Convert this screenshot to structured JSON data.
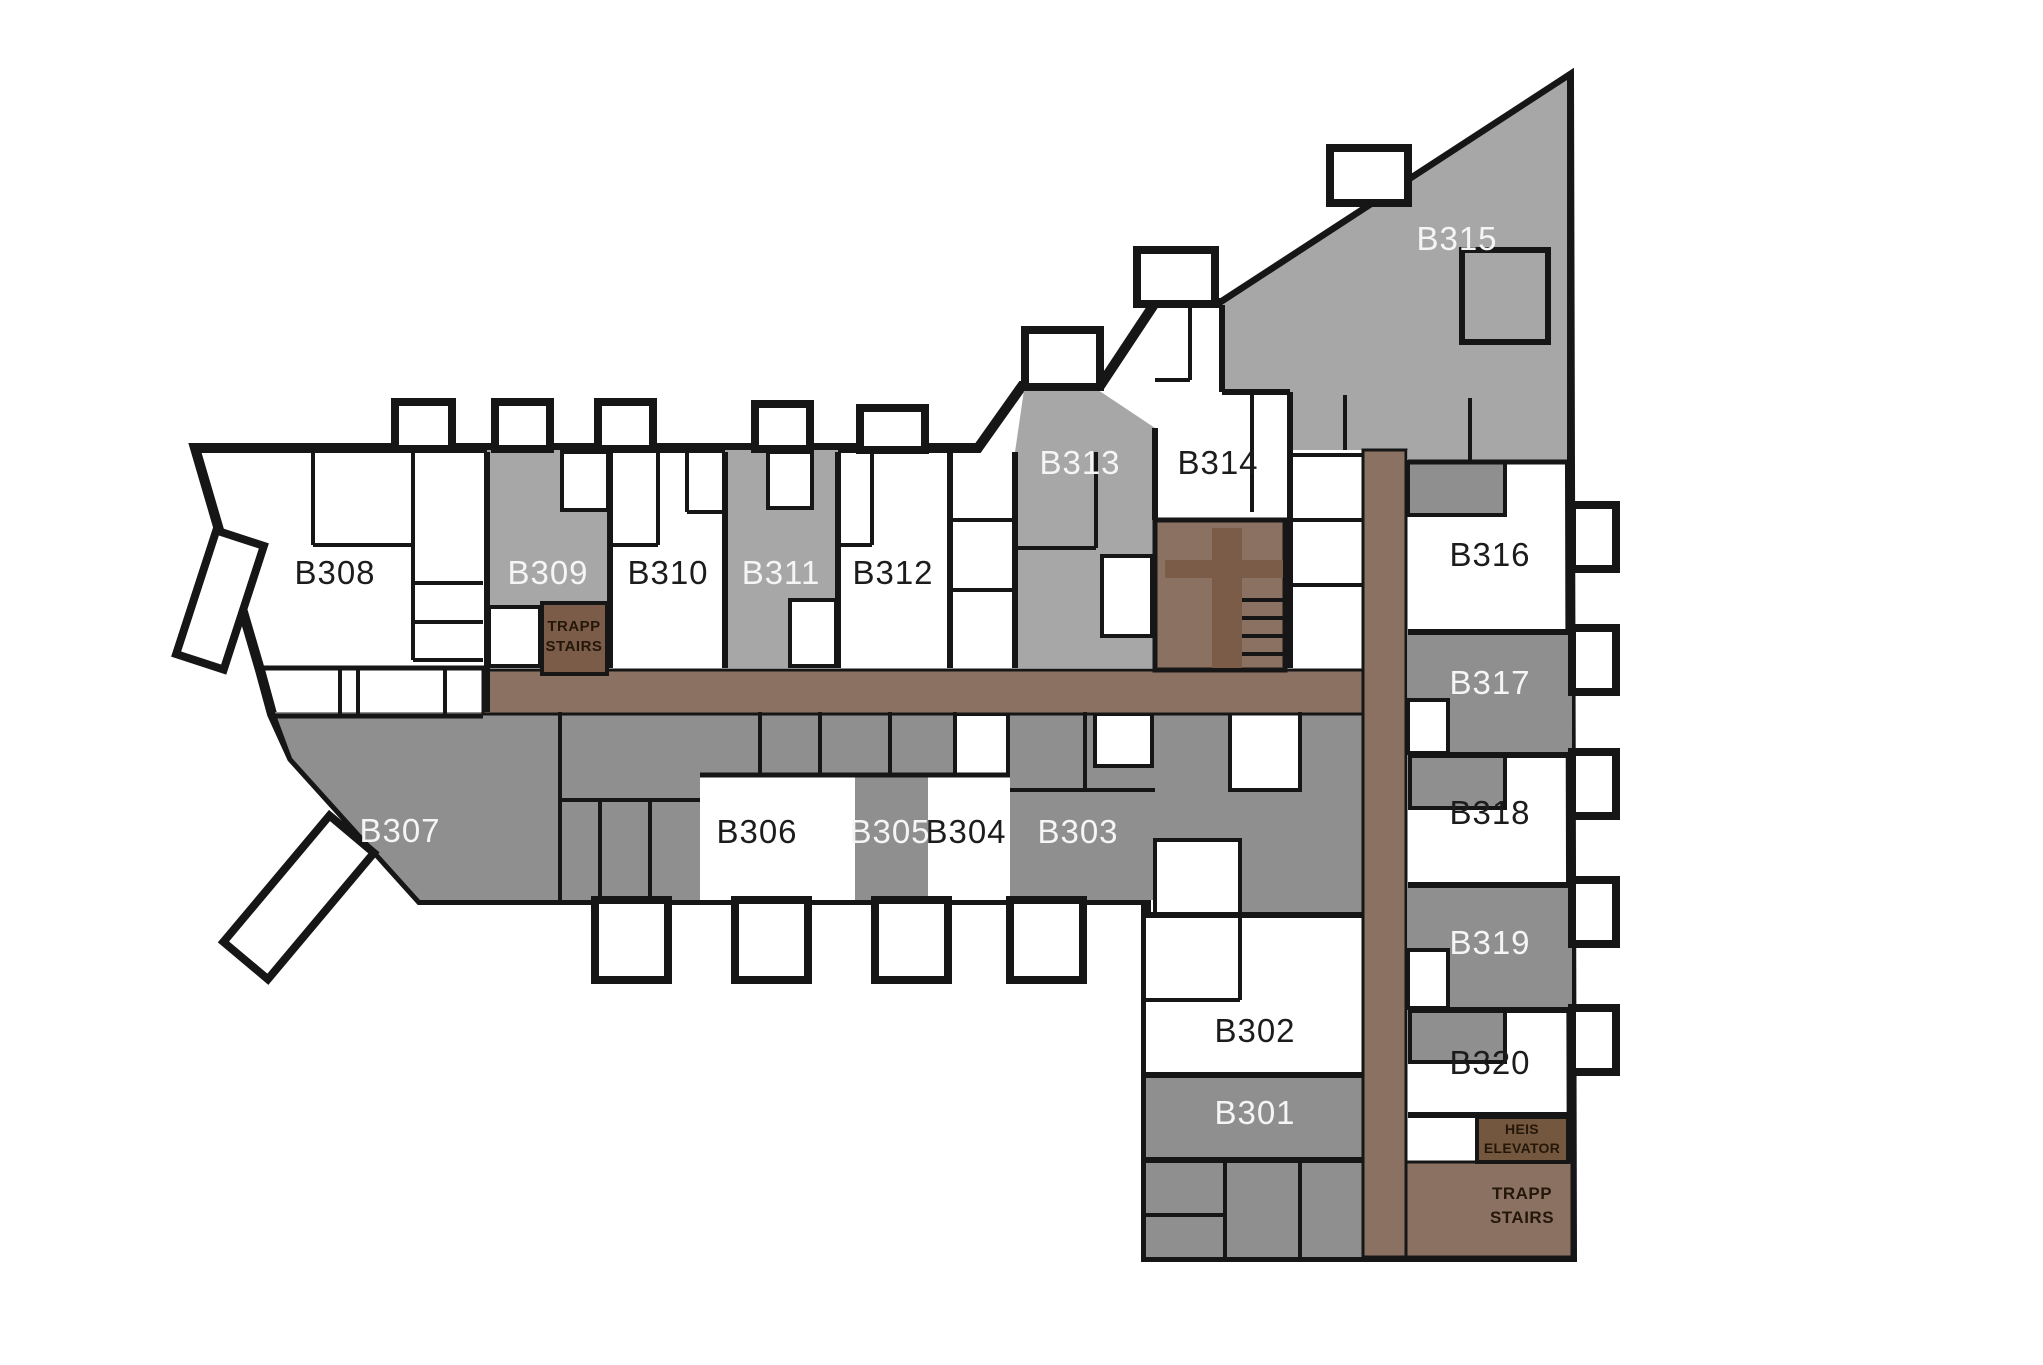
{
  "plan_type": "apartment-floor-plan",
  "rooms": [
    {
      "id": "B301",
      "label": "B301",
      "shade": "gray"
    },
    {
      "id": "B302",
      "label": "B302",
      "shade": "white"
    },
    {
      "id": "B303",
      "label": "B303",
      "shade": "gray"
    },
    {
      "id": "B304",
      "label": "B304",
      "shade": "white"
    },
    {
      "id": "B305",
      "label": "B305",
      "shade": "gray"
    },
    {
      "id": "B306",
      "label": "B306",
      "shade": "white"
    },
    {
      "id": "B307",
      "label": "B307",
      "shade": "gray"
    },
    {
      "id": "B308",
      "label": "B308",
      "shade": "white"
    },
    {
      "id": "B309",
      "label": "B309",
      "shade": "gray"
    },
    {
      "id": "B310",
      "label": "B310",
      "shade": "white"
    },
    {
      "id": "B311",
      "label": "B311",
      "shade": "gray"
    },
    {
      "id": "B312",
      "label": "B312",
      "shade": "white"
    },
    {
      "id": "B313",
      "label": "B313",
      "shade": "gray"
    },
    {
      "id": "B314",
      "label": "B314",
      "shade": "white"
    },
    {
      "id": "B315",
      "label": "B315",
      "shade": "gray"
    },
    {
      "id": "B316",
      "label": "B316",
      "shade": "white"
    },
    {
      "id": "B317",
      "label": "B317",
      "shade": "gray"
    },
    {
      "id": "B318",
      "label": "B318",
      "shade": "white"
    },
    {
      "id": "B319",
      "label": "B319",
      "shade": "gray"
    },
    {
      "id": "B320",
      "label": "B320",
      "shade": "white"
    }
  ],
  "stairs_upper": {
    "line1": "TRAPP",
    "line2": "STAIRS"
  },
  "stairs_lower": {
    "line1": "TRAPP",
    "line2": "STAIRS"
  },
  "elevator": {
    "line1": "HEIS",
    "line2": "ELEVATOR"
  },
  "colors": {
    "wall": "#161616",
    "room_white": "#ffffff",
    "room_gray_light": "#a7a7a7",
    "room_gray_dark": "#8f8f8f",
    "corridor": "#8a7161",
    "stairwell": "#7a5c49",
    "elevator": "#74573f",
    "label_on_gray": "#f5f5f5",
    "label_on_white": "#1c1c1c",
    "stair_text": "#241709"
  }
}
